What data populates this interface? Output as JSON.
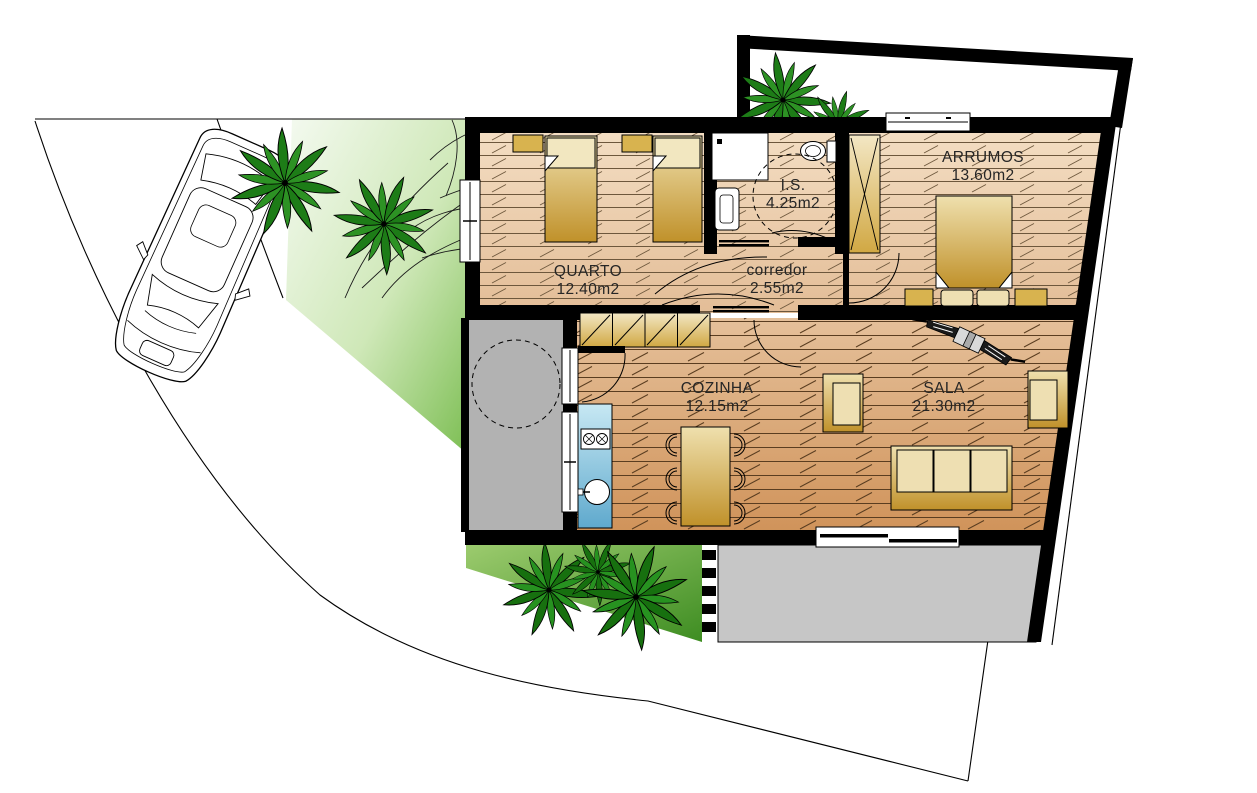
{
  "plan": {
    "title": "Single-storey house floor plan with site, parking and gardens",
    "rooms": {
      "quarto": {
        "name": "QUARTO",
        "area": "12.40m2"
      },
      "is": {
        "name": "I.S.",
        "area": "4.25m2"
      },
      "corredor": {
        "name": "corredor",
        "area": "2.55m2"
      },
      "arrumos": {
        "name": "ARRUMOS",
        "area": "13.60m2"
      },
      "cozinha": {
        "name": "COZINHA",
        "area": "12.15m2"
      },
      "sala": {
        "name": "SALA",
        "area": "21.30m2"
      }
    },
    "colors": {
      "wall": "#000000",
      "bedroom_floor": "#eed4b5",
      "living_floor": "#d89a63",
      "patio_gray": "#b2b2b2",
      "deck_gray": "#c6c6c6",
      "lawn_light": "#f2f8ec",
      "lawn_green": "#7ebf55",
      "lawn_dark_green": "#3e8d22",
      "palm_green": "#1d7c17",
      "furniture_gold_light": "#f2e4ba",
      "furniture_gold_dark": "#c2962d",
      "counter_blue_light": "#c7e8f3",
      "counter_blue_dark": "#5fa9cd"
    }
  }
}
